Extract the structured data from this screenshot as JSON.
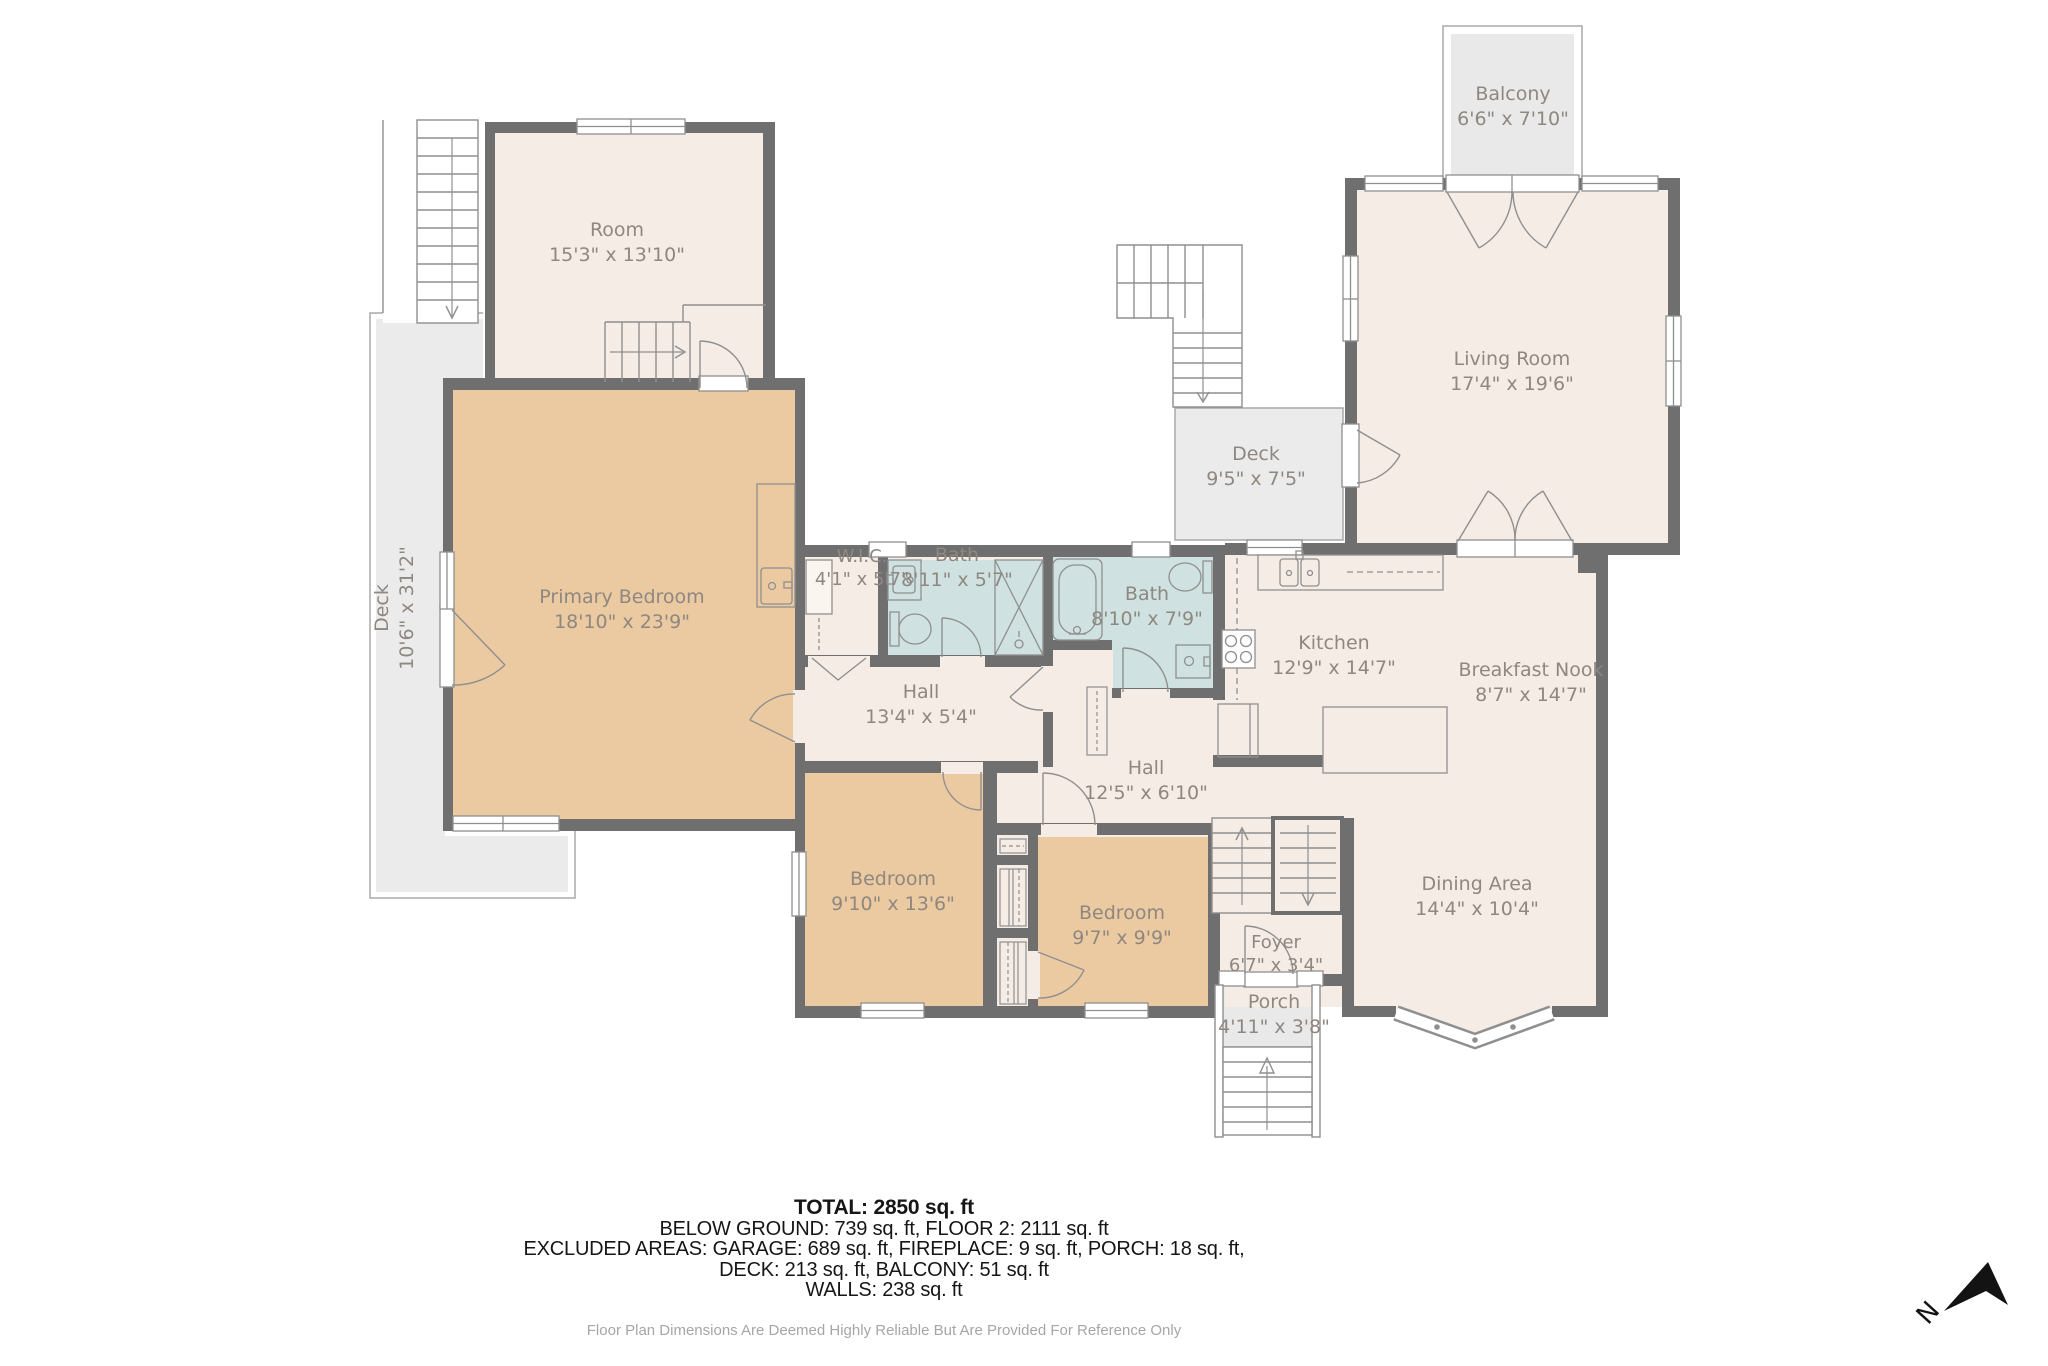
{
  "plan": {
    "rooms": {
      "room": {
        "name": "Room",
        "dims": "15'3\" x 13'10\""
      },
      "balcony": {
        "name": "Balcony",
        "dims": "6'6\" x 7'10\""
      },
      "living": {
        "name": "Living Room",
        "dims": "17'4\" x 19'6\""
      },
      "deck_mid": {
        "name": "Deck",
        "dims": "9'5\" x 7'5\""
      },
      "deck_left": {
        "name": "Deck",
        "dims": "10'6\" x 31'2\""
      },
      "primary": {
        "name": "Primary Bedroom",
        "dims": "18'10\" x 23'9\""
      },
      "wic": {
        "name": "W.I.C.",
        "dims": "4'1\" x 5'7\""
      },
      "bath1": {
        "name": "Bath",
        "dims": "8'11\" x 5'7\""
      },
      "bath2": {
        "name": "Bath",
        "dims": "8'10\" x 7'9\""
      },
      "kitchen": {
        "name": "Kitchen",
        "dims": "12'9\" x 14'7\""
      },
      "nook": {
        "name": "Breakfast Nook",
        "dims": "8'7\" x 14'7\""
      },
      "hall1": {
        "name": "Hall",
        "dims": "13'4\" x 5'4\""
      },
      "hall2": {
        "name": "Hall",
        "dims": "12'5\" x 6'10\""
      },
      "bedroom1": {
        "name": "Bedroom",
        "dims": "9'10\" x 13'6\""
      },
      "bedroom2": {
        "name": "Bedroom",
        "dims": "9'7\" x 9'9\""
      },
      "foyer": {
        "name": "Foyer",
        "dims": "6'7\" x 3'4\""
      },
      "porch": {
        "name": "Porch",
        "dims": "4'11\" x 3'8\""
      },
      "dining": {
        "name": "Dining Area",
        "dims": "14'4\" x 10'4\""
      }
    },
    "footer": {
      "total": "TOTAL: 2850 sq. ft",
      "line1": "BELOW GROUND: 739 sq. ft, FLOOR 2: 2111 sq. ft",
      "line2": "EXCLUDED AREAS: GARAGE: 689 sq. ft, FIREPLACE: 9 sq. ft, PORCH: 18 sq. ft,",
      "line3": "DECK: 213 sq. ft, BALCONY: 51 sq. ft",
      "line4": "WALLS: 238 sq. ft",
      "disclaimer": "Floor Plan Dimensions Are Deemed Highly Reliable But Are Provided For Reference Only"
    },
    "compass": {
      "label": "N"
    },
    "colors": {
      "wall": "#6f6f6f",
      "floor": "#f5ece5",
      "bedroom": "#ebc9a1",
      "bath": "#cfe2e1",
      "deck": "#ebebeb",
      "label_text": "#8e8880"
    }
  }
}
